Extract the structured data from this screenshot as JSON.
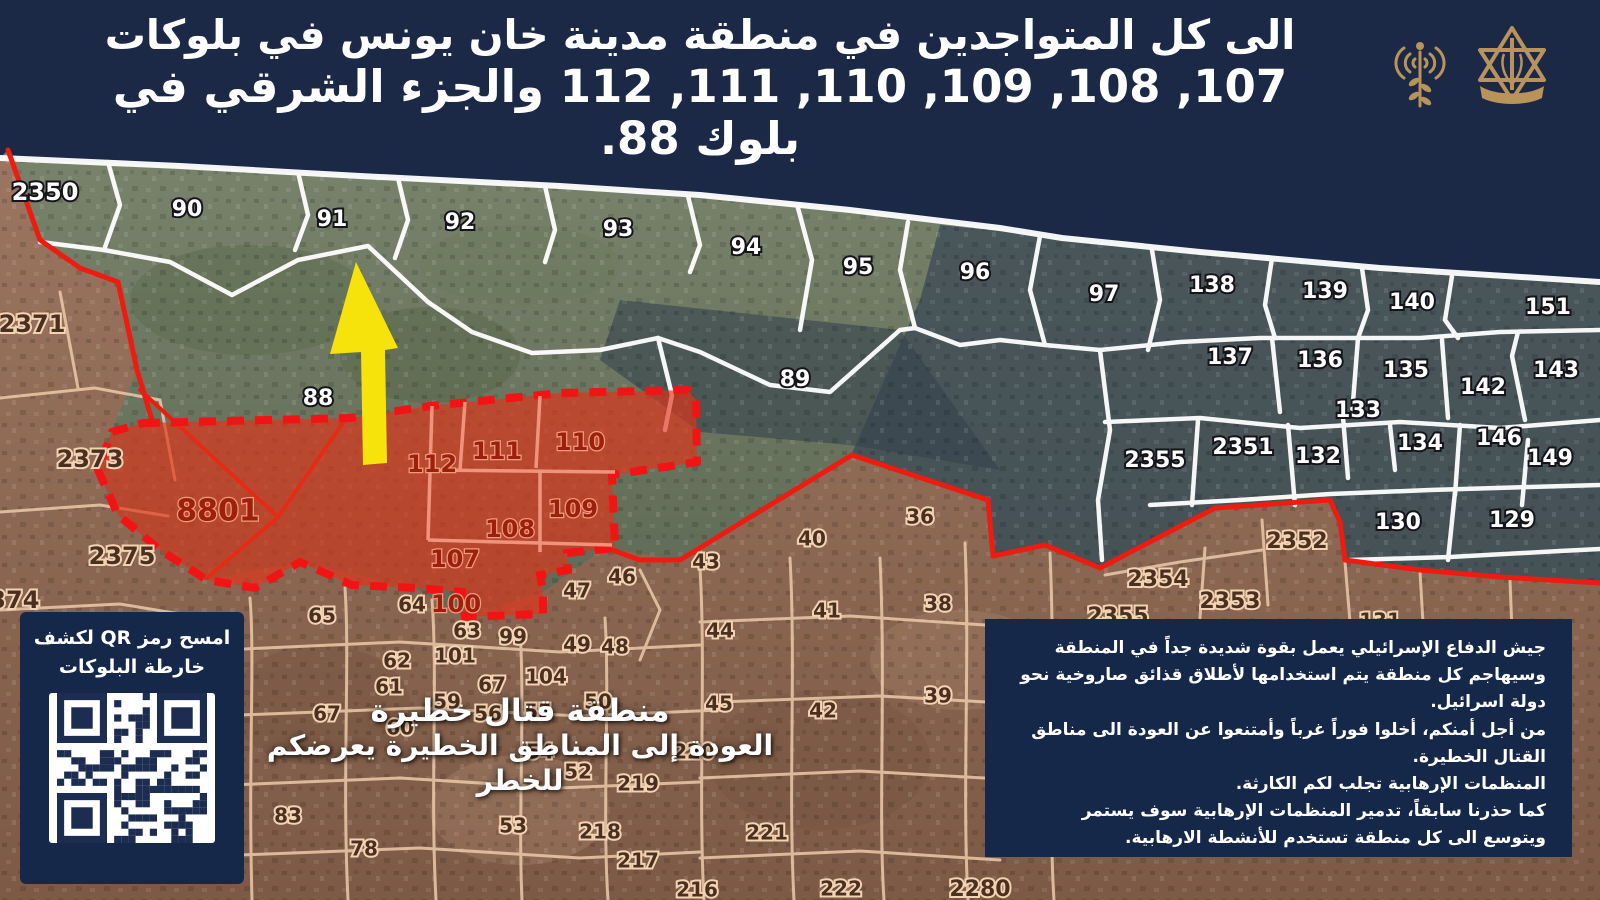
{
  "header": {
    "line1": "الى كل المتواجدين في منطقة مدينة خان يونس في بلوكات",
    "line2": "107, 108, 109, 110, 111, 112 والجزء الشرقي في بلوك 88.",
    "logo_left": "idf-arabic-spokesperson-radio-logo",
    "logo_right": "idf-army-emblem-logo",
    "logo_color": "#b8935a"
  },
  "qr_panel": {
    "title_line1": "امسح رمز QR لكشف",
    "title_line2": "خارطة البلوكات"
  },
  "warning": {
    "line1": "منطقة قتال خطيرة",
    "line2": "العودة إلى المناطق الخطيرة يعرضكم للخطر"
  },
  "info_box": {
    "lines": [
      "جيش الدفاع الإسرائيلي يعمل بقوة شديدة جداً في المنطقة",
      "وسيهاجم كل منطقة يتم استخدامها لأطلاق قذائق صاروخية نحو",
      "دولة اسرائيل.",
      "من أجل أمنكم، أخلوا فوراً غرباً وأمتنعوا عن العودة الى مناطق",
      "القتال الخطيرة.",
      "المنظمات الإرهابية تجلب لكم الكارثة.",
      "كما حذرنا سابقاً، تدمير المنظمات الإرهابية سوف يستمر",
      "ويتوسع الى كل منطقة تستخدم للأنشطة الارهابية."
    ]
  },
  "colors": {
    "navy": "#1b2947",
    "panel_navy": "#16284a",
    "red_zone_fill": "#e23418",
    "red_border": "#ee1b10",
    "yellow_arrow": "#f6e30b",
    "gold_logo": "#b8935a",
    "tan_lines": "#eccaa9"
  },
  "map": {
    "evacuation_blocks": [
      "107",
      "108",
      "109",
      "110",
      "111",
      "112",
      "8801",
      "100"
    ],
    "labels": [
      {
        "t": "2350",
        "x": 45,
        "y": 193,
        "c": "w",
        "s": 24
      },
      {
        "t": "90",
        "x": 187,
        "y": 210,
        "c": "w",
        "s": 22
      },
      {
        "t": "91",
        "x": 332,
        "y": 220,
        "c": "w",
        "s": 22
      },
      {
        "t": "92",
        "x": 460,
        "y": 223,
        "c": "w",
        "s": 22
      },
      {
        "t": "93",
        "x": 618,
        "y": 230,
        "c": "w",
        "s": 22
      },
      {
        "t": "94",
        "x": 746,
        "y": 248,
        "c": "w",
        "s": 22
      },
      {
        "t": "95",
        "x": 858,
        "y": 268,
        "c": "w",
        "s": 22
      },
      {
        "t": "96",
        "x": 975,
        "y": 273,
        "c": "w",
        "s": 22
      },
      {
        "t": "97",
        "x": 1104,
        "y": 295,
        "c": "w",
        "s": 22
      },
      {
        "t": "138",
        "x": 1212,
        "y": 286,
        "c": "w",
        "s": 22
      },
      {
        "t": "139",
        "x": 1325,
        "y": 292,
        "c": "w",
        "s": 22
      },
      {
        "t": "140",
        "x": 1412,
        "y": 303,
        "c": "w",
        "s": 22
      },
      {
        "t": "151",
        "x": 1548,
        "y": 308,
        "c": "w",
        "s": 22
      },
      {
        "t": "137",
        "x": 1230,
        "y": 358,
        "c": "w",
        "s": 22
      },
      {
        "t": "136",
        "x": 1320,
        "y": 361,
        "c": "w",
        "s": 22
      },
      {
        "t": "135",
        "x": 1406,
        "y": 371,
        "c": "w",
        "s": 22
      },
      {
        "t": "142",
        "x": 1483,
        "y": 388,
        "c": "w",
        "s": 22
      },
      {
        "t": "143",
        "x": 1556,
        "y": 371,
        "c": "w",
        "s": 22
      },
      {
        "t": "133",
        "x": 1358,
        "y": 411,
        "c": "w",
        "s": 22
      },
      {
        "t": "134",
        "x": 1420,
        "y": 444,
        "c": "w",
        "s": 22
      },
      {
        "t": "146",
        "x": 1499,
        "y": 439,
        "c": "w",
        "s": 22
      },
      {
        "t": "149",
        "x": 1550,
        "y": 459,
        "c": "w",
        "s": 22
      },
      {
        "t": "132",
        "x": 1318,
        "y": 457,
        "c": "w",
        "s": 22
      },
      {
        "t": "2351",
        "x": 1243,
        "y": 448,
        "c": "w",
        "s": 22
      },
      {
        "t": "2355",
        "x": 1155,
        "y": 461,
        "c": "w",
        "s": 22
      },
      {
        "t": "130",
        "x": 1398,
        "y": 523,
        "c": "w",
        "s": 22
      },
      {
        "t": "129",
        "x": 1512,
        "y": 521,
        "c": "w",
        "s": 22
      },
      {
        "t": "88",
        "x": 318,
        "y": 399,
        "c": "w",
        "s": 22
      },
      {
        "t": "89",
        "x": 795,
        "y": 380,
        "c": "w",
        "s": 22
      },
      {
        "t": "2371",
        "x": 32,
        "y": 325,
        "c": "b",
        "s": 24
      },
      {
        "t": "2373",
        "x": 90,
        "y": 460,
        "c": "b",
        "s": 24
      },
      {
        "t": "2375",
        "x": 122,
        "y": 557,
        "c": "b",
        "s": 24
      },
      {
        "t": "2374",
        "x": 6,
        "y": 601,
        "c": "b",
        "s": 24
      },
      {
        "t": "65",
        "x": 322,
        "y": 617,
        "c": "b",
        "s": 20
      },
      {
        "t": "64",
        "x": 412,
        "y": 606,
        "c": "b",
        "s": 20
      },
      {
        "t": "63",
        "x": 467,
        "y": 632,
        "c": "b",
        "s": 20
      },
      {
        "t": "99",
        "x": 513,
        "y": 638,
        "c": "b",
        "s": 20
      },
      {
        "t": "101",
        "x": 455,
        "y": 657,
        "c": "b",
        "s": 20
      },
      {
        "t": "62",
        "x": 397,
        "y": 662,
        "c": "b",
        "s": 20
      },
      {
        "t": "61",
        "x": 389,
        "y": 688,
        "c": "b",
        "s": 20
      },
      {
        "t": "59",
        "x": 447,
        "y": 703,
        "c": "b",
        "s": 20
      },
      {
        "t": "67",
        "x": 492,
        "y": 686,
        "c": "b",
        "s": 20
      },
      {
        "t": "104",
        "x": 546,
        "y": 678,
        "c": "b",
        "s": 20
      },
      {
        "t": "67",
        "x": 327,
        "y": 715,
        "c": "b",
        "s": 20
      },
      {
        "t": "60",
        "x": 400,
        "y": 729,
        "c": "b",
        "s": 20
      },
      {
        "t": "56",
        "x": 488,
        "y": 715,
        "c": "b",
        "s": 20
      },
      {
        "t": "55",
        "x": 538,
        "y": 713,
        "c": "b",
        "s": 20
      },
      {
        "t": "50",
        "x": 598,
        "y": 703,
        "c": "b",
        "s": 20
      },
      {
        "t": "49",
        "x": 577,
        "y": 646,
        "c": "b",
        "s": 20
      },
      {
        "t": "48",
        "x": 615,
        "y": 648,
        "c": "b",
        "s": 20
      },
      {
        "t": "47",
        "x": 577,
        "y": 592,
        "c": "b",
        "s": 20
      },
      {
        "t": "46",
        "x": 622,
        "y": 578,
        "c": "b",
        "s": 20
      },
      {
        "t": "43",
        "x": 706,
        "y": 563,
        "c": "b",
        "s": 20
      },
      {
        "t": "44",
        "x": 720,
        "y": 632,
        "c": "b",
        "s": 20
      },
      {
        "t": "45",
        "x": 719,
        "y": 705,
        "c": "b",
        "s": 20
      },
      {
        "t": "40",
        "x": 812,
        "y": 540,
        "c": "b",
        "s": 20
      },
      {
        "t": "36",
        "x": 920,
        "y": 518,
        "c": "b",
        "s": 20
      },
      {
        "t": "41",
        "x": 827,
        "y": 612,
        "c": "b",
        "s": 20
      },
      {
        "t": "38",
        "x": 938,
        "y": 605,
        "c": "b",
        "s": 20
      },
      {
        "t": "42",
        "x": 823,
        "y": 712,
        "c": "b",
        "s": 20
      },
      {
        "t": "39",
        "x": 938,
        "y": 697,
        "c": "b",
        "s": 20
      },
      {
        "t": "54",
        "x": 540,
        "y": 753,
        "c": "b",
        "s": 20
      },
      {
        "t": "52",
        "x": 578,
        "y": 773,
        "c": "b",
        "s": 20
      },
      {
        "t": "53",
        "x": 513,
        "y": 827,
        "c": "b",
        "s": 20
      },
      {
        "t": "219",
        "x": 638,
        "y": 785,
        "c": "b",
        "s": 20
      },
      {
        "t": "220",
        "x": 694,
        "y": 753,
        "c": "b",
        "s": 20
      },
      {
        "t": "218",
        "x": 600,
        "y": 833,
        "c": "b",
        "s": 20
      },
      {
        "t": "217",
        "x": 638,
        "y": 862,
        "c": "b",
        "s": 20
      },
      {
        "t": "216",
        "x": 697,
        "y": 891,
        "c": "b",
        "s": 20
      },
      {
        "t": "221",
        "x": 767,
        "y": 834,
        "c": "b",
        "s": 20
      },
      {
        "t": "222",
        "x": 841,
        "y": 890,
        "c": "b",
        "s": 20
      },
      {
        "t": "2280",
        "x": 980,
        "y": 890,
        "c": "b",
        "s": 22
      },
      {
        "t": "83",
        "x": 288,
        "y": 817,
        "c": "b",
        "s": 20
      },
      {
        "t": "78",
        "x": 364,
        "y": 850,
        "c": "b",
        "s": 20
      },
      {
        "t": "2354",
        "x": 1158,
        "y": 580,
        "c": "b",
        "s": 22
      },
      {
        "t": "2353",
        "x": 1230,
        "y": 602,
        "c": "b",
        "s": 22
      },
      {
        "t": "2355",
        "x": 1118,
        "y": 617,
        "c": "b",
        "s": 22
      },
      {
        "t": "2352",
        "x": 1297,
        "y": 542,
        "c": "b",
        "s": 22
      },
      {
        "t": "131",
        "x": 1380,
        "y": 622,
        "c": "b",
        "s": 20
      },
      {
        "t": "8801",
        "x": 218,
        "y": 512,
        "c": "r",
        "s": 30
      },
      {
        "t": "112",
        "x": 432,
        "y": 465,
        "c": "r",
        "s": 24
      },
      {
        "t": "111",
        "x": 497,
        "y": 452,
        "c": "r",
        "s": 24
      },
      {
        "t": "110",
        "x": 580,
        "y": 443,
        "c": "r",
        "s": 24
      },
      {
        "t": "109",
        "x": 573,
        "y": 510,
        "c": "r",
        "s": 24
      },
      {
        "t": "108",
        "x": 510,
        "y": 530,
        "c": "r",
        "s": 24
      },
      {
        "t": "107",
        "x": 455,
        "y": 560,
        "c": "r",
        "s": 24
      },
      {
        "t": "100",
        "x": 456,
        "y": 605,
        "c": "r",
        "s": 24
      }
    ]
  }
}
